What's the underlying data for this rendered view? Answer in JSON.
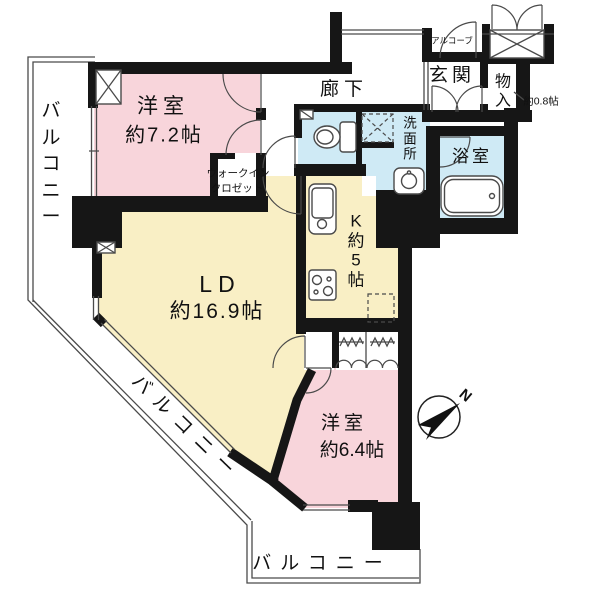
{
  "floorplan": {
    "rooms": {
      "bedroom1": {
        "name": "洋室",
        "size": "約7.2帖"
      },
      "wic": {
        "line1": "ウォークイン",
        "line2": "クロゼット"
      },
      "corridor": {
        "name": "廊下"
      },
      "alcove": {
        "name": "アルコーブ"
      },
      "entrance": {
        "name": "玄関"
      },
      "storage": {
        "name": "物入",
        "size": "約0.8帖"
      },
      "washroom": {
        "name": "洗面所"
      },
      "bathroom": {
        "name": "浴室"
      },
      "kitchen": {
        "name": "K約5帖"
      },
      "living": {
        "name": "LD",
        "size": "約16.9帖"
      },
      "bedroom2": {
        "name": "洋室",
        "size": "約6.4帖"
      },
      "balcony_left": {
        "name": "バルコニー"
      },
      "balcony_diagonal": {
        "name": "バルコニー"
      },
      "balcony_bottom": {
        "name": "バルコニー"
      }
    },
    "compass": {
      "label": "N"
    },
    "colors": {
      "pink": "#f8d5db",
      "cream": "#f9efc5",
      "blue": "#cfeaf5",
      "wall": "#161616",
      "line": "#4a4a4a"
    }
  }
}
